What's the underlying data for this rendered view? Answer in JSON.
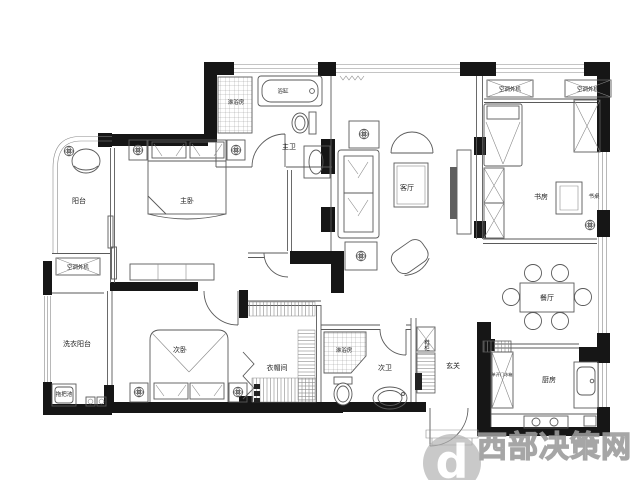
{
  "page": {
    "background": "#ffffff",
    "type": "apartment-floor-plan"
  },
  "labels": {
    "balcony": "阳台",
    "master_bedroom": "主卧",
    "master_shower": "淋浴房",
    "bathtub": "浴缸",
    "master_bath": "主卫",
    "living_room": "客厅",
    "ac_unit_top_1": "空调外机",
    "ac_unit_top_2": "空调外机",
    "study": "书房",
    "desk": "书桌",
    "ac_unit_left": "空调外机",
    "laundry_balcony": "洗衣阳台",
    "mop_pool": "拖把池",
    "second_bedroom": "次卧",
    "cloakroom": "衣帽间",
    "second_shower": "淋浴房",
    "second_bath": "次卫",
    "shoe_cabinet": "鞋柜",
    "entry": "玄关",
    "fridge": "单开门冰箱",
    "dining_room": "餐厅",
    "kitchen": "厨房"
  },
  "watermark": {
    "text": "西部决策网",
    "logo_letter": "d",
    "color": "#b3b3b3"
  },
  "colors": {
    "wall": "#161616",
    "line": "#5a5a5a",
    "label": "#222222",
    "watermark": "#b3b3b3"
  }
}
